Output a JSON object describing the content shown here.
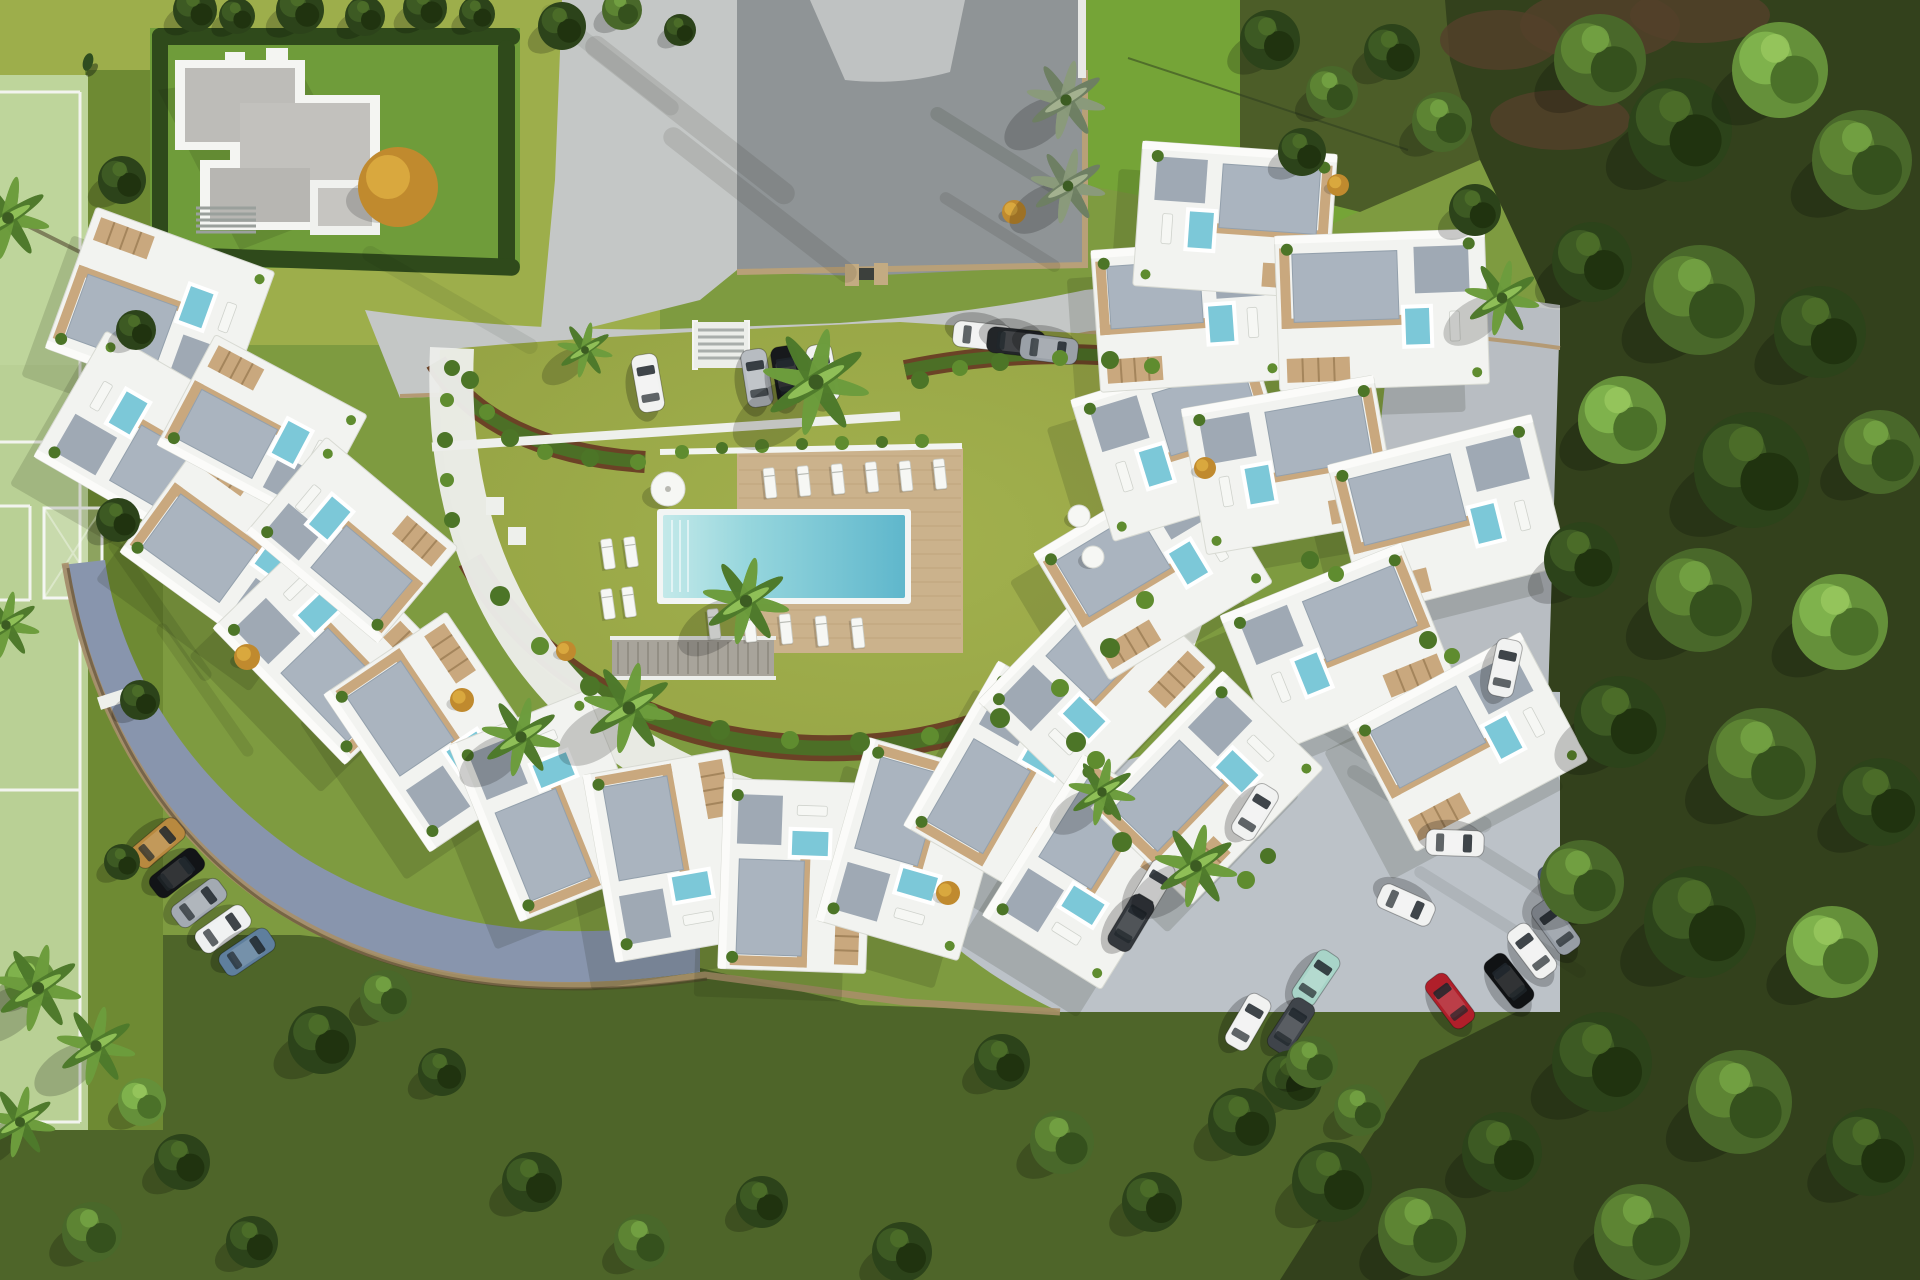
{
  "palette": {
    "grass_base": "#7e9b40",
    "grass_bright": "#9dae4b",
    "grass_tr": "#75a437",
    "grass_court": "#98a647",
    "grass_dark": "#4e6529",
    "grass_field": "#b9d095",
    "field_margin": "#6e8a33",
    "forest": "#33411c",
    "forest_edge": "#4c5d28",
    "soil_brown": "#54402b",
    "road_light": "#c4c7c6",
    "road_asphalt": "#8f9496",
    "road_blue": "#8895ad",
    "parking": "#bcc2c8",
    "road_right": "#b8bdc2",
    "curb_tan": "#b49a74",
    "wall_tan": "#a98f68",
    "wall_dark": "#4a3a26",
    "white_bldg": "#f2f3f0",
    "white_trim": "#fbfbf9",
    "bldg_stroke": "#d8dad3",
    "gravel": "#aab4bf",
    "gravel_dark": "#9fa9b4",
    "deck_tan": "#c9a87e",
    "deck_big": "#cbb28c",
    "plank": "#a98a5e",
    "pool_light": "#bfe7e8",
    "pool_mid": "#7cc9d6",
    "pool_deep": "#5fb7cc",
    "pool_small": "#7cc8d8",
    "hedge": "#2f4a1b",
    "bed_soil": "#6b4226",
    "bed_green": "#4c6f26",
    "shrub1": "#4c7527",
    "shrub2": "#5f8c2f",
    "gold": "#c08a2e",
    "gold_light": "#d9a83e",
    "lounger": "#f6f7f4",
    "shadow": "#1b2410"
  },
  "scene": {
    "buildings": [
      [
        160,
        310,
        20,
        190,
        150
      ],
      [
        150,
        440,
        30,
        185,
        145
      ],
      [
        240,
        548,
        36,
        190,
        148
      ],
      [
        332,
        645,
        46,
        190,
        148
      ],
      [
        438,
        732,
        56,
        190,
        148
      ],
      [
        553,
        806,
        68,
        190,
        148
      ],
      [
        672,
        856,
        80,
        190,
        148
      ],
      [
        795,
        876,
        92,
        190,
        148
      ],
      [
        913,
        849,
        106,
        190,
        148
      ],
      [
        1015,
        780,
        120,
        190,
        148
      ],
      [
        1097,
        684,
        134,
        190,
        148
      ],
      [
        1153,
        568,
        149,
        190,
        148
      ],
      [
        1183,
        443,
        163,
        190,
        148
      ],
      [
        1188,
        315,
        176,
        185,
        142
      ],
      [
        1235,
        220,
        184,
        195,
        145
      ],
      [
        1382,
        310,
        178,
        210,
        155
      ],
      [
        1290,
        465,
        170,
        195,
        148
      ],
      [
        1448,
        515,
        166,
        210,
        155
      ],
      [
        1338,
        648,
        158,
        195,
        148
      ],
      [
        1468,
        742,
        152,
        195,
        145
      ],
      [
        1092,
        872,
        122,
        190,
        140
      ],
      [
        1207,
        788,
        134,
        190,
        140
      ],
      [
        262,
        430,
        28,
        172,
        125
      ],
      [
        352,
        540,
        40,
        172,
        125
      ]
    ],
    "cars": [
      [
        648,
        383,
        -10,
        "#f1f2f1"
      ],
      [
        757,
        378,
        -9,
        "#b7bcc1"
      ],
      [
        787,
        375,
        -9,
        "#17191c"
      ],
      [
        823,
        373,
        -11,
        "#f1f2f1"
      ],
      [
        982,
        336,
        96,
        "#f1f2f1"
      ],
      [
        1016,
        342,
        96,
        "#222528"
      ],
      [
        1049,
        349,
        97,
        "#9aa0a7"
      ],
      [
        1505,
        668,
        12,
        "#f1f2f1"
      ],
      [
        158,
        843,
        50,
        "#b8893f"
      ],
      [
        177,
        873,
        52,
        "#121417"
      ],
      [
        199,
        903,
        53,
        "#a3aab2"
      ],
      [
        223,
        929,
        55,
        "#eef0f0"
      ],
      [
        247,
        952,
        56,
        "#5f7f9d"
      ],
      [
        1255,
        812,
        32,
        "#f1f2f1"
      ],
      [
        1152,
        888,
        31,
        "#f1f2f1"
      ],
      [
        1131,
        923,
        31,
        "#34383d"
      ],
      [
        1316,
        978,
        34,
        "#a8d4c8"
      ],
      [
        1291,
        1026,
        33,
        "#3f444a"
      ],
      [
        1248,
        1022,
        30,
        "#f1f2f1"
      ],
      [
        1455,
        843,
        92,
        "#f1f2f1"
      ],
      [
        1406,
        905,
        114,
        "#f1f2f1"
      ],
      [
        1562,
        889,
        -35,
        "#4a5670"
      ],
      [
        1556,
        927,
        -36,
        "#969da5"
      ],
      [
        1532,
        951,
        -37,
        "#f1f2f1"
      ],
      [
        1509,
        981,
        -38,
        "#101214"
      ],
      [
        1450,
        1001,
        -37,
        "#b01f2a"
      ]
    ],
    "trees": [
      [
        1600,
        60,
        46,
        "m"
      ],
      [
        1680,
        130,
        52,
        "d"
      ],
      [
        1780,
        70,
        48,
        "l"
      ],
      [
        1862,
        160,
        50,
        "m"
      ],
      [
        1592,
        262,
        40,
        "d"
      ],
      [
        1700,
        300,
        55,
        "m"
      ],
      [
        1820,
        332,
        46,
        "d"
      ],
      [
        1622,
        420,
        44,
        "l"
      ],
      [
        1752,
        470,
        58,
        "d"
      ],
      [
        1880,
        452,
        42,
        "m"
      ],
      [
        1582,
        560,
        38,
        "d"
      ],
      [
        1700,
        600,
        52,
        "m"
      ],
      [
        1840,
        622,
        48,
        "l"
      ],
      [
        1620,
        722,
        46,
        "d"
      ],
      [
        1762,
        762,
        54,
        "m"
      ],
      [
        1880,
        802,
        44,
        "d"
      ],
      [
        1582,
        882,
        42,
        "m"
      ],
      [
        1700,
        922,
        56,
        "d"
      ],
      [
        1832,
        952,
        46,
        "l"
      ],
      [
        1602,
        1062,
        50,
        "d"
      ],
      [
        1740,
        1102,
        52,
        "m"
      ],
      [
        1870,
        1152,
        44,
        "d"
      ],
      [
        1642,
        1232,
        48,
        "m"
      ],
      [
        1502,
        1152,
        40,
        "d"
      ],
      [
        1422,
        1232,
        44,
        "m"
      ],
      [
        1332,
        1182,
        40,
        "d"
      ],
      [
        1292,
        1080,
        30,
        "d"
      ],
      [
        1360,
        1110,
        26,
        "m"
      ],
      [
        1270,
        40,
        30,
        "d"
      ],
      [
        1332,
        92,
        26,
        "m"
      ],
      [
        1392,
        52,
        28,
        "d"
      ],
      [
        1302,
        152,
        24,
        "d"
      ],
      [
        1442,
        122,
        30,
        "m"
      ],
      [
        1475,
        210,
        26,
        "d"
      ],
      [
        195,
        10,
        22,
        "d"
      ],
      [
        237,
        16,
        18,
        "d"
      ],
      [
        300,
        10,
        24,
        "d"
      ],
      [
        365,
        16,
        20,
        "d"
      ],
      [
        425,
        8,
        22,
        "d"
      ],
      [
        477,
        14,
        18,
        "d"
      ],
      [
        562,
        26,
        24,
        "d"
      ],
      [
        622,
        10,
        20,
        "m"
      ],
      [
        680,
        30,
        16,
        "d"
      ],
      [
        322,
        1040,
        34,
        "d"
      ],
      [
        386,
        996,
        26,
        "m"
      ],
      [
        442,
        1072,
        24,
        "d"
      ],
      [
        532,
        1182,
        30,
        "d"
      ],
      [
        642,
        1242,
        28,
        "m"
      ],
      [
        762,
        1202,
        26,
        "d"
      ],
      [
        902,
        1252,
        30,
        "d"
      ],
      [
        1002,
        1062,
        28,
        "d"
      ],
      [
        1062,
        1142,
        32,
        "m"
      ],
      [
        1152,
        1202,
        30,
        "d"
      ],
      [
        1242,
        1122,
        34,
        "d"
      ],
      [
        1312,
        1062,
        26,
        "m"
      ],
      [
        182,
        1162,
        28,
        "d"
      ],
      [
        92,
        1232,
        30,
        "m"
      ],
      [
        252,
        1242,
        26,
        "d"
      ],
      [
        30,
        982,
        26,
        "l"
      ],
      [
        142,
        1102,
        24,
        "l"
      ],
      [
        122,
        180,
        24,
        "d"
      ],
      [
        136,
        330,
        20,
        "d"
      ],
      [
        118,
        520,
        22,
        "d"
      ],
      [
        140,
        700,
        20,
        "d"
      ],
      [
        122,
        862,
        18,
        "d"
      ]
    ],
    "palms": [
      [
        816,
        382,
        54,
        "g"
      ],
      [
        746,
        601,
        44,
        "g"
      ],
      [
        629,
        708,
        46,
        "g"
      ],
      [
        521,
        737,
        40,
        "g"
      ],
      [
        585,
        350,
        28,
        "g"
      ],
      [
        1066,
        100,
        40,
        "s"
      ],
      [
        1068,
        186,
        38,
        "s"
      ],
      [
        1502,
        298,
        38,
        "g"
      ],
      [
        1196,
        866,
        42,
        "g"
      ],
      [
        1102,
        792,
        34,
        "g"
      ],
      [
        38,
        988,
        44,
        "g"
      ],
      [
        96,
        1046,
        40,
        "g"
      ],
      [
        20,
        1122,
        36,
        "g"
      ],
      [
        8,
        218,
        42,
        "g"
      ],
      [
        6,
        625,
        34,
        "g"
      ]
    ],
    "shrubs": [
      [
        470,
        380,
        9,
        1
      ],
      [
        487,
        412,
        8,
        2
      ],
      [
        510,
        438,
        9,
        1
      ],
      [
        545,
        452,
        8,
        2
      ],
      [
        590,
        458,
        9,
        1
      ],
      [
        638,
        462,
        8,
        2
      ],
      [
        500,
        596,
        10,
        1
      ],
      [
        540,
        646,
        9,
        2
      ],
      [
        590,
        686,
        10,
        1
      ],
      [
        650,
        712,
        9,
        2
      ],
      [
        720,
        730,
        10,
        1
      ],
      [
        790,
        740,
        9,
        2
      ],
      [
        860,
        742,
        10,
        1
      ],
      [
        930,
        736,
        9,
        2
      ],
      [
        1000,
        718,
        10,
        1
      ],
      [
        1060,
        688,
        9,
        2
      ],
      [
        1110,
        648,
        10,
        1
      ],
      [
        1145,
        600,
        9,
        2
      ],
      [
        920,
        380,
        9,
        1
      ],
      [
        960,
        368,
        8,
        2
      ],
      [
        1000,
        362,
        9,
        1
      ],
      [
        1060,
        358,
        8,
        2
      ],
      [
        1110,
        360,
        9,
        1
      ],
      [
        1152,
        366,
        8,
        2
      ],
      [
        682,
        452,
        7,
        2
      ],
      [
        722,
        448,
        6,
        1
      ],
      [
        762,
        446,
        7,
        2
      ],
      [
        802,
        444,
        6,
        1
      ],
      [
        842,
        443,
        7,
        2
      ],
      [
        882,
        442,
        6,
        1
      ],
      [
        922,
        441,
        7,
        2
      ],
      [
        1076,
        742,
        10,
        1
      ],
      [
        1096,
        760,
        9,
        2
      ],
      [
        1122,
        842,
        10,
        1
      ],
      [
        1246,
        880,
        9,
        2
      ],
      [
        1268,
        856,
        8,
        1
      ],
      [
        1310,
        560,
        9,
        1
      ],
      [
        1336,
        574,
        8,
        2
      ],
      [
        1428,
        640,
        9,
        1
      ],
      [
        1452,
        656,
        8,
        2
      ],
      [
        452,
        368,
        8,
        1
      ],
      [
        447,
        400,
        7,
        2
      ],
      [
        445,
        440,
        8,
        1
      ],
      [
        447,
        480,
        7,
        2
      ],
      [
        452,
        520,
        8,
        1
      ]
    ],
    "gold_bushes": [
      [
        398,
        187,
        40
      ],
      [
        247,
        657,
        13
      ],
      [
        462,
        700,
        12
      ],
      [
        1014,
        212,
        12
      ],
      [
        948,
        893,
        12
      ],
      [
        566,
        651,
        10
      ],
      [
        1205,
        468,
        11
      ],
      [
        1338,
        185,
        11
      ]
    ],
    "loungers": [
      [
        770,
        483,
        -6
      ],
      [
        804,
        481,
        -6
      ],
      [
        838,
        479,
        -6
      ],
      [
        872,
        477,
        -6
      ],
      [
        906,
        476,
        -6
      ],
      [
        940,
        474,
        -6
      ],
      [
        714,
        624,
        -6
      ],
      [
        750,
        627,
        -6
      ],
      [
        786,
        629,
        -6
      ],
      [
        822,
        631,
        -6
      ],
      [
        858,
        633,
        -6
      ],
      [
        608,
        554,
        -8
      ],
      [
        631,
        552,
        -8
      ],
      [
        608,
        604,
        -8
      ],
      [
        629,
        602,
        -8
      ]
    ],
    "pads": [
      [
        495,
        506
      ],
      [
        517,
        536
      ]
    ],
    "tables": [
      [
        1079,
        516
      ],
      [
        1093,
        557
      ]
    ],
    "parasol": [
      668,
      489
    ],
    "streaks": [
      [
        690,
        120,
        260,
        22,
        38,
        0.1
      ],
      [
        760,
        205,
        240,
        20,
        38,
        0.1
      ],
      [
        610,
        60,
        170,
        16,
        38,
        0.08
      ],
      [
        995,
        150,
        150,
        14,
        32,
        0.12
      ],
      [
        1000,
        232,
        140,
        12,
        32,
        0.1
      ],
      [
        1380,
        760,
        260,
        16,
        32,
        0.1
      ],
      [
        1450,
        832,
        240,
        14,
        32,
        0.1
      ],
      [
        1500,
        922,
        200,
        12,
        32,
        0.08
      ],
      [
        160,
        610,
        170,
        13,
        55,
        0.12
      ],
      [
        205,
        690,
        160,
        12,
        55,
        0.1
      ],
      [
        450,
        300,
        200,
        16,
        30,
        0.08
      ],
      [
        1240,
        350,
        180,
        14,
        30,
        0.08
      ]
    ],
    "soil_patches": [
      [
        1500,
        40,
        60,
        30
      ],
      [
        1600,
        25,
        80,
        36
      ],
      [
        1560,
        120,
        70,
        30
      ],
      [
        1700,
        15,
        70,
        28
      ]
    ]
  }
}
